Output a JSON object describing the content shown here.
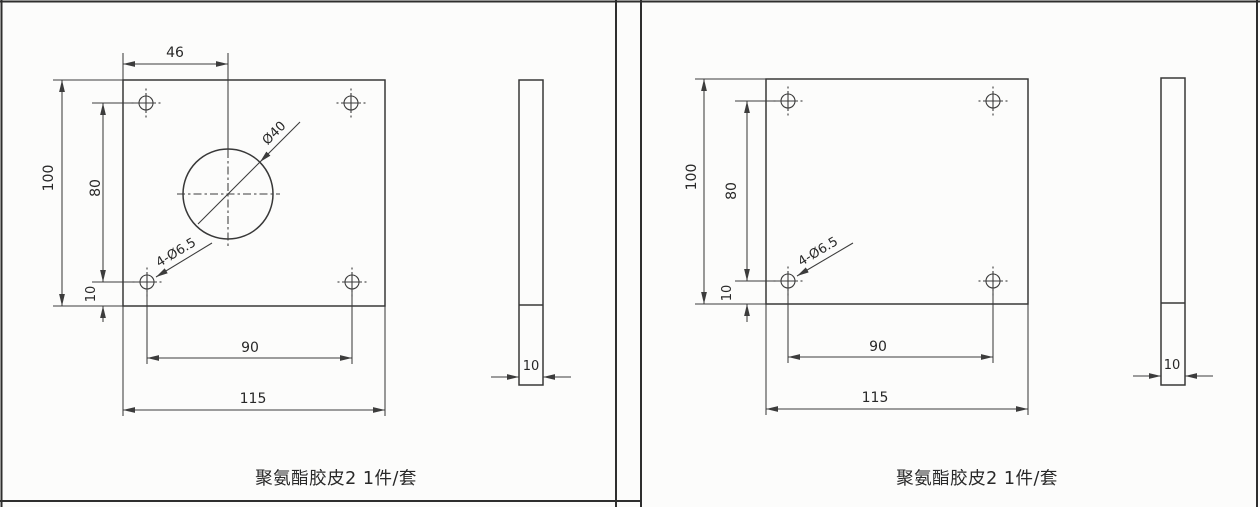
{
  "sheet": {
    "kind": "scanned engineering drawing, two cells",
    "colors": {
      "background": "#fcfcfb",
      "line": "#3c3c3c",
      "text": "#282828"
    }
  },
  "panels": [
    {
      "id": "left",
      "caption": "聚氨酯胶皮2 1件/套",
      "front_view": {
        "dim_hole_center_offset_x": "46",
        "dim_height": "100",
        "dim_hole_span_v": "80",
        "dim_hole_edge_offset": "10",
        "dim_hole_span_h": "90",
        "dim_width": "115",
        "label_center_hole": "Ø40",
        "label_corner_holes": "4-Ø6.5"
      },
      "side_view": {
        "dim_thickness": "10"
      }
    },
    {
      "id": "right",
      "caption": "聚氨酯胶皮2 1件/套",
      "front_view": {
        "dim_height": "100",
        "dim_hole_span_v": "80",
        "dim_hole_edge_offset": "10",
        "dim_hole_span_h": "90",
        "dim_width": "115",
        "label_corner_holes": "4-Ø6.5"
      },
      "side_view": {
        "dim_thickness": "10"
      }
    }
  ]
}
